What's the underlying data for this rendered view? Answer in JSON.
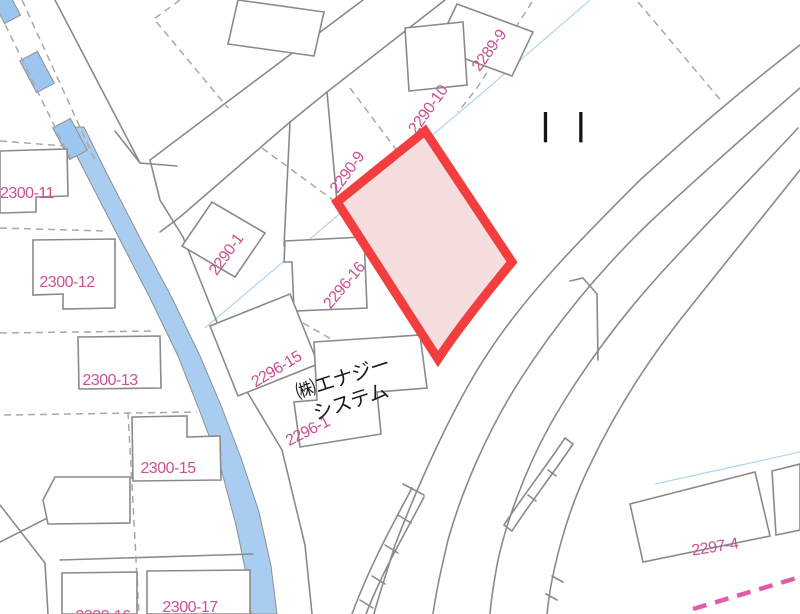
{
  "map": {
    "type": "cadastral-map",
    "colors": {
      "background": "#ffffff",
      "parcel_line": "#8a8a8a",
      "dashed_boundary": "#a8a8a8",
      "canal_fill": "#a9cdf1",
      "culvert_fill": "#9cc6ef",
      "water_hairline": "#b5d6f0",
      "highlight_stroke": "#f23e3e",
      "highlight_fill": "#f6dede",
      "label_pink": "#cb5094",
      "boundary_pink_dash": "#e05da5",
      "company_text": "#1c1c1c"
    },
    "parcel_labels": [
      {
        "text": "2300-11",
        "x": 27,
        "y": 194,
        "deg": 0
      },
      {
        "text": "2300-12",
        "x": 67,
        "y": 283,
        "deg": 0
      },
      {
        "text": "2300-13",
        "x": 110,
        "y": 381,
        "deg": 0
      },
      {
        "text": "2300-15",
        "x": 168,
        "y": 469,
        "deg": 0
      },
      {
        "text": "2300-16",
        "x": 103,
        "y": 617,
        "deg": 0
      },
      {
        "text": "2300-17",
        "x": 190,
        "y": 608,
        "deg": 0
      },
      {
        "text": "2290-1",
        "x": 227,
        "y": 255,
        "deg": -54
      },
      {
        "text": "2290-9",
        "x": 348,
        "y": 173,
        "deg": -54
      },
      {
        "text": "2290-10",
        "x": 429,
        "y": 110,
        "deg": -54
      },
      {
        "text": "2289-9",
        "x": 490,
        "y": 51,
        "deg": -54
      },
      {
        "text": "2296-16",
        "x": 345,
        "y": 286,
        "deg": -50
      },
      {
        "text": "2296-15",
        "x": 277,
        "y": 370,
        "deg": -31
      },
      {
        "text": "2296-1",
        "x": 308,
        "y": 432,
        "deg": -27
      },
      {
        "text": "2297-4",
        "x": 715,
        "y": 548,
        "deg": -9
      },
      {
        "text": "㈱エナジー\nシステム",
        "x": 347,
        "y": 391,
        "deg": -18,
        "color": "#1c1c1c",
        "size": 20
      }
    ],
    "bridge_symbol": {
      "text": "| |"
    }
  }
}
